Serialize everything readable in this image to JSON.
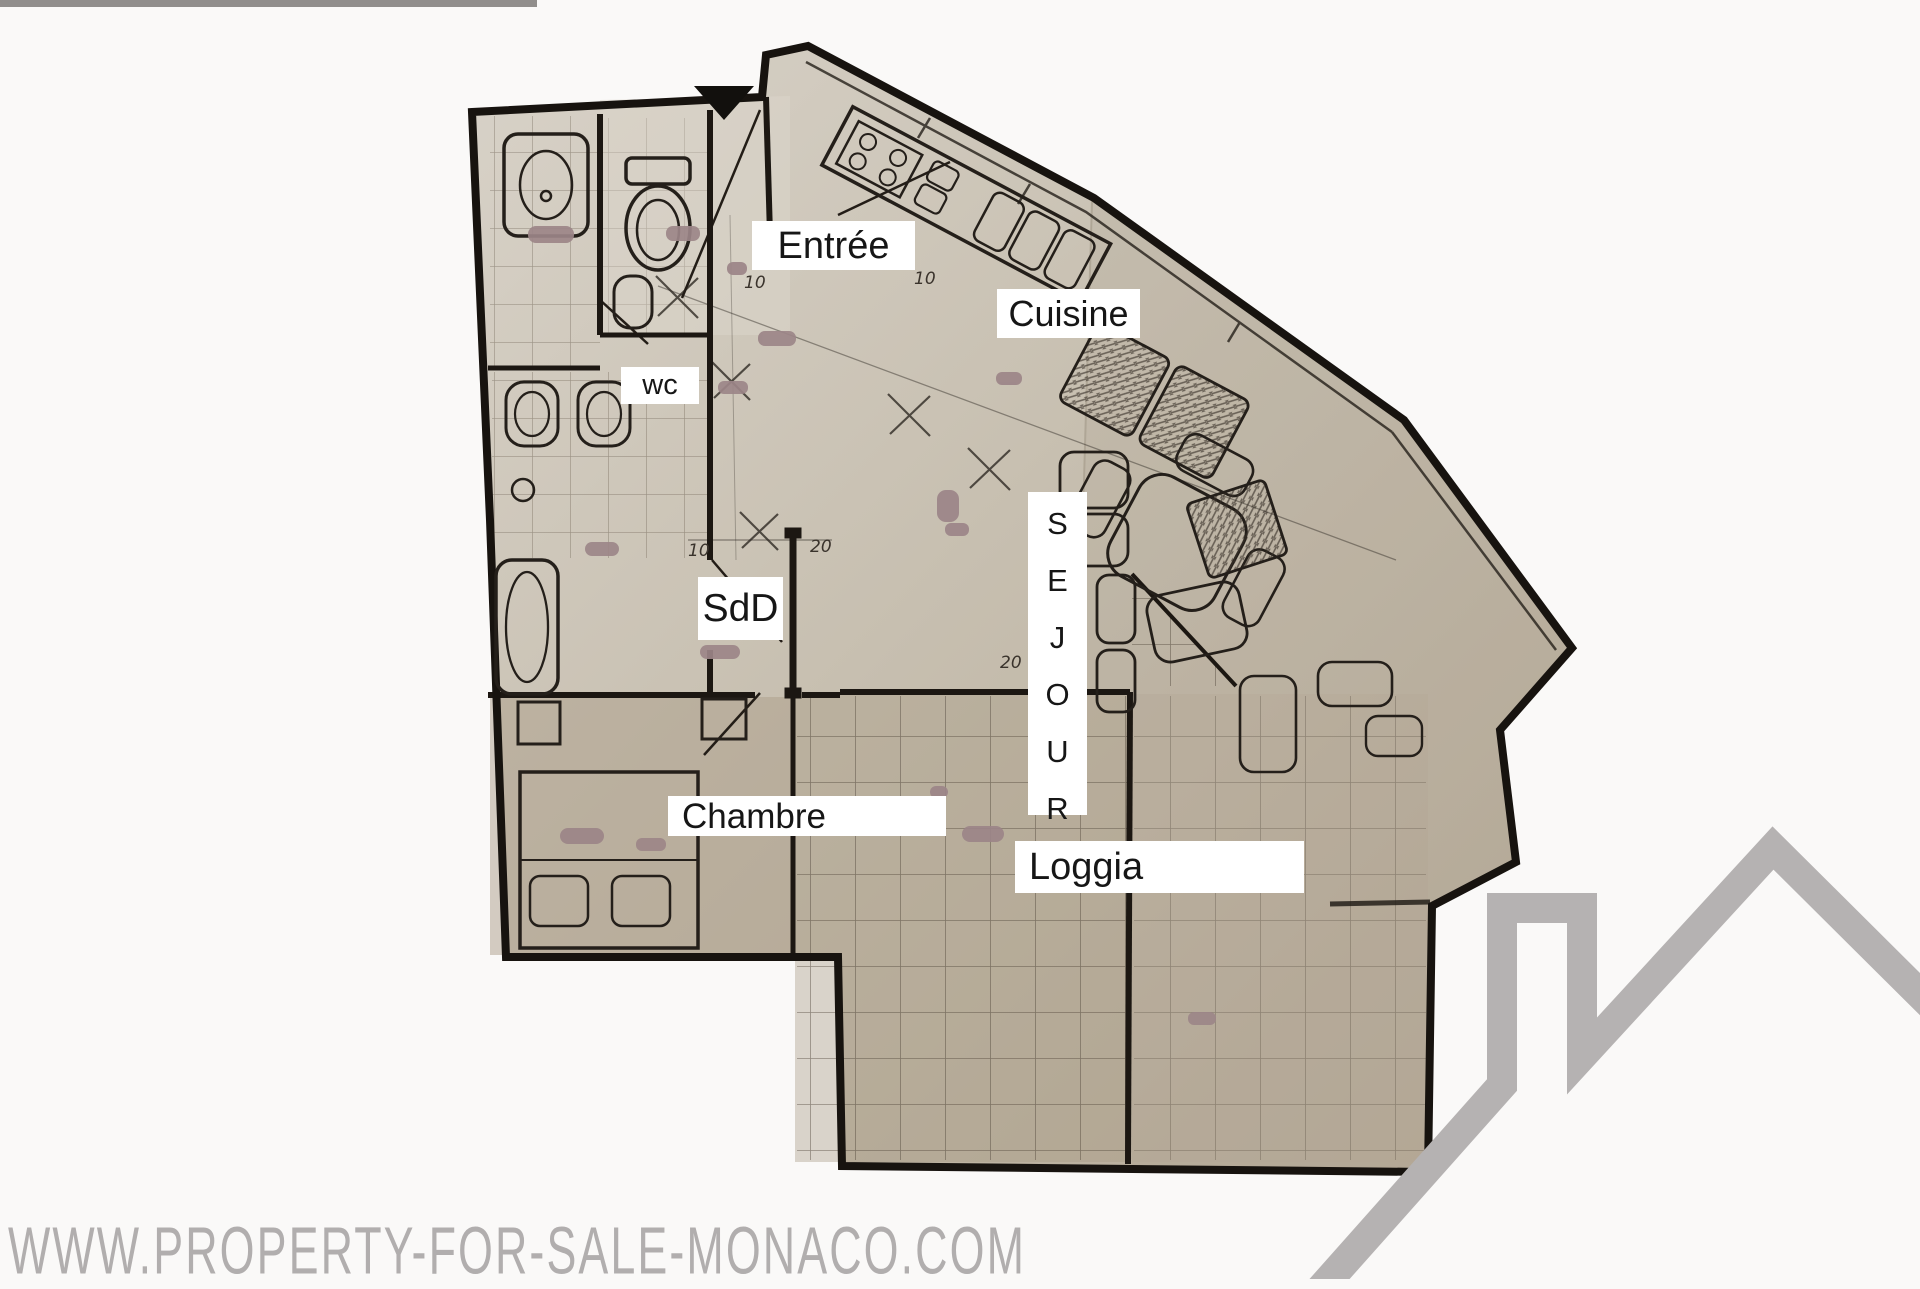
{
  "page": {
    "background_color": "#faf9f8",
    "top_strip_color": "#7e7b79"
  },
  "floorplan": {
    "labels": {
      "entree": "Entrée",
      "cuisine": "Cuisine",
      "wc": "wc",
      "sdd": "SdD",
      "sejour": "SEJOUR",
      "chambre": "Chambre",
      "loggia": "Loggia"
    },
    "ticks": [
      "10",
      "10",
      "10",
      "20",
      "20"
    ],
    "paper_color": "#c9c1b3",
    "wall_color": "#1c1712",
    "redaction_color": "#9c8588",
    "label_background": "#ffffff",
    "label_text_color": "#161616"
  },
  "watermark": {
    "text": "WWW.PROPERTY-FOR-SALE-MONACO.COM",
    "color": "#b1aeae"
  },
  "logo": {
    "description": "house-roof-with-chimney",
    "color": "#b5b2b2"
  }
}
